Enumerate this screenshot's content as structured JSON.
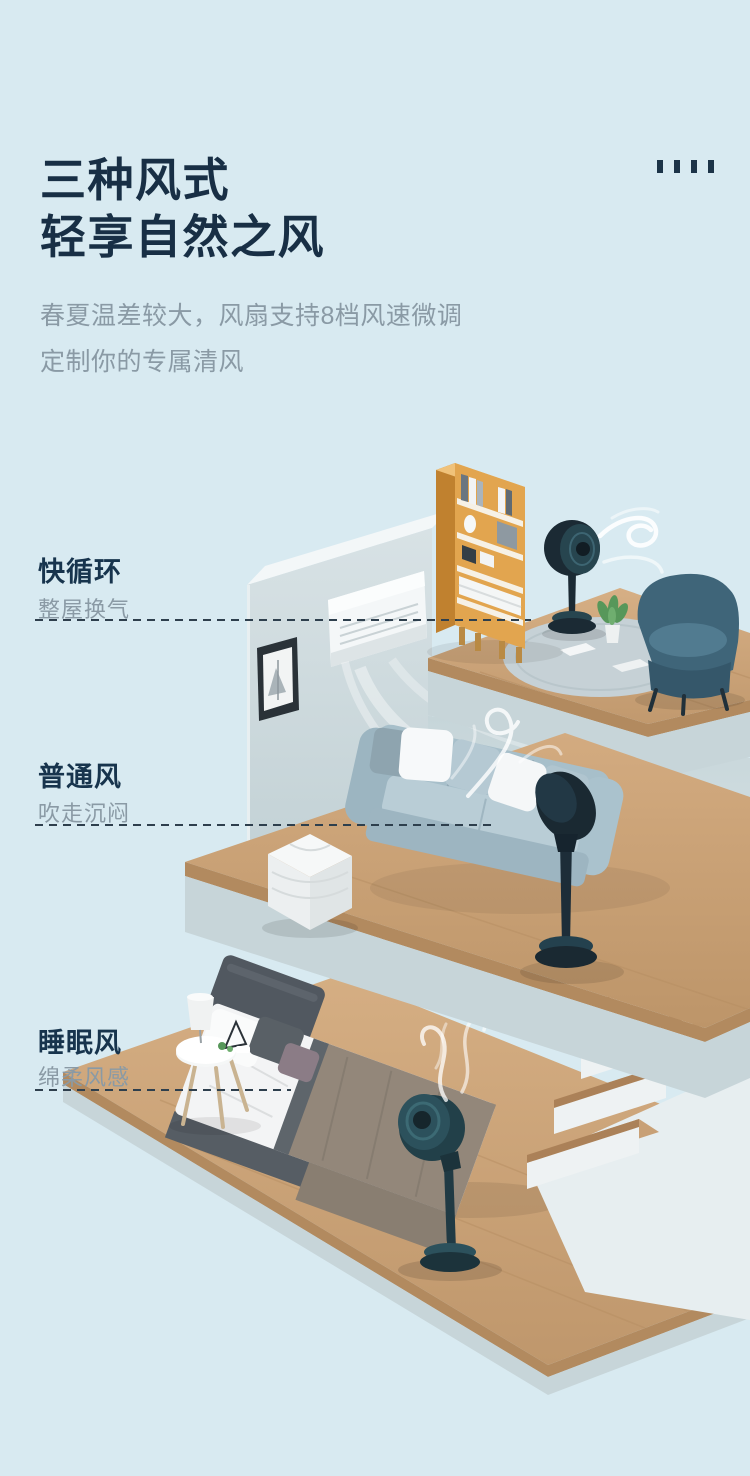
{
  "page": {
    "background": "#d8eaf1",
    "accent_dark": "#17344c",
    "text_gray": "#8a9aa5",
    "dash_line_color": "#2e3f4d"
  },
  "header": {
    "title_line1": "三种风式",
    "title_line2": "轻享自然之风",
    "subtitle_line1": "春夏温差较大，风扇支持8档风速微调",
    "subtitle_line2": "定制你的专属清风"
  },
  "modes": [
    {
      "name": "快循环",
      "desc": "整屋换气"
    },
    {
      "name": "普通风",
      "desc": "吹走沉闷"
    },
    {
      "name": "睡眠风",
      "desc": "绵柔风感"
    }
  ],
  "illustration": {
    "colors": {
      "wood_floor": "#c9a177",
      "wall": "#c9d7da",
      "fan_body": "#1b2a34",
      "fan_accent": "#27454f",
      "bookshelf_wood": "#e2a54f",
      "sofa": "#a7bfca",
      "armchair": "#3f6579",
      "bed_blanket": "#93877a"
    },
    "objects": [
      "wall-mounted-ac",
      "picture-frame",
      "bookshelf",
      "circulation-fan",
      "armchair",
      "rug",
      "sofa",
      "pouf",
      "bed",
      "side-table",
      "lamp",
      "stairs",
      "wind-swirl"
    ]
  }
}
